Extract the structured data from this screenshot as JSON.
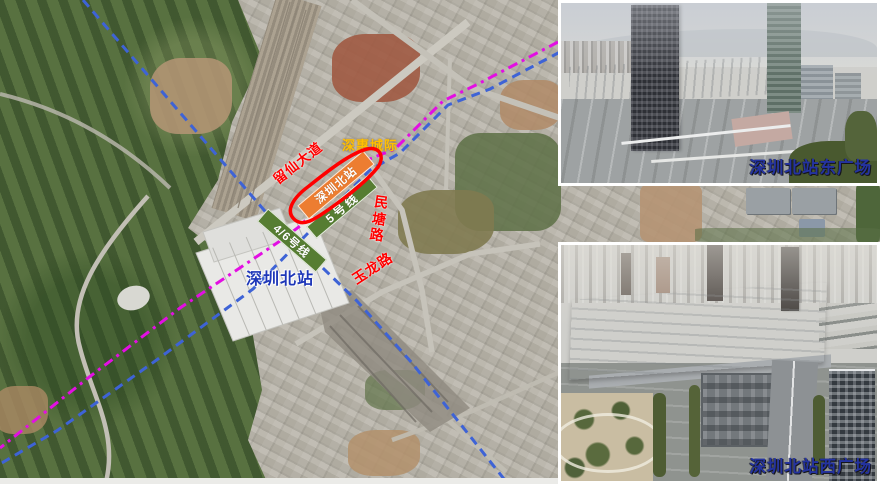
{
  "map": {
    "labels": {
      "liuxian_avenue": "留仙大道",
      "shenhui_intercity": "深惠城际",
      "station_bar": "深圳北站",
      "line5": "5号线",
      "line46": "4/6号线",
      "mintang_road": "民塘路",
      "yulong_road": "玉龙路",
      "station_name": "深圳北站"
    },
    "colors": {
      "intercity_dashed_line": "#E30EE3",
      "rail_dashed_line": "#3E63D6",
      "station_bar_fill": "#ED7D31",
      "metro_bar_fill": "#567D32",
      "highlight_outline": "#FF0000",
      "road_label_color": "#FF0000",
      "intercity_label_color": "#FFC000",
      "station_label_color": "#1D36B8"
    }
  },
  "insets": [
    {
      "label": "深圳北站东广场"
    },
    {
      "label": "深圳北站西广场"
    }
  ]
}
